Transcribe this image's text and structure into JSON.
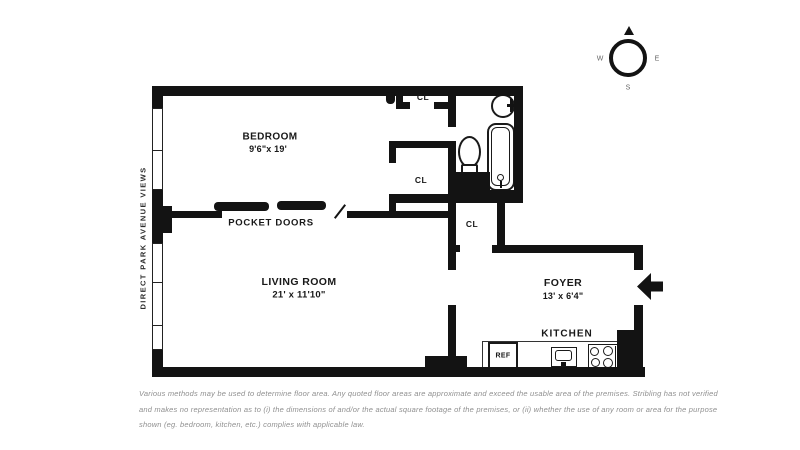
{
  "side_note": "DIRECT PARK AVENUE VIEWS",
  "rooms": {
    "bedroom": {
      "name": "BEDROOM",
      "dims": "9'6\"x 19'"
    },
    "living_room": {
      "name": "LIVING ROOM",
      "dims": "21' x 11'10\""
    },
    "foyer": {
      "name": "FOYER",
      "dims": "13' x 6'4\""
    },
    "kitchen": {
      "name": "KITCHEN"
    }
  },
  "closets": {
    "bedroom_top": "CL",
    "bedroom_mid": "CL",
    "hall": "CL"
  },
  "features": {
    "pocket_doors": "POCKET DOORS",
    "refrigerator": "REF"
  },
  "compass": {
    "west": "W",
    "east": "E",
    "south": "S"
  },
  "disclaimer": {
    "line1": "Various methods may be used to determine floor area. Any quoted floor areas are approximate and exceed the usable area of the premises. Stribling has not verified",
    "line2": "and makes no representation as to (i) the dimensions of and/or the actual square footage of the premises, or (ii) whether the use of any room or area for the purpose",
    "line3": "shown (eg. bedroom, kitchen, etc.) complies with applicable law."
  },
  "colors": {
    "wall": "#131313",
    "label": "#181818",
    "muted_text": "#8f8f8f"
  }
}
